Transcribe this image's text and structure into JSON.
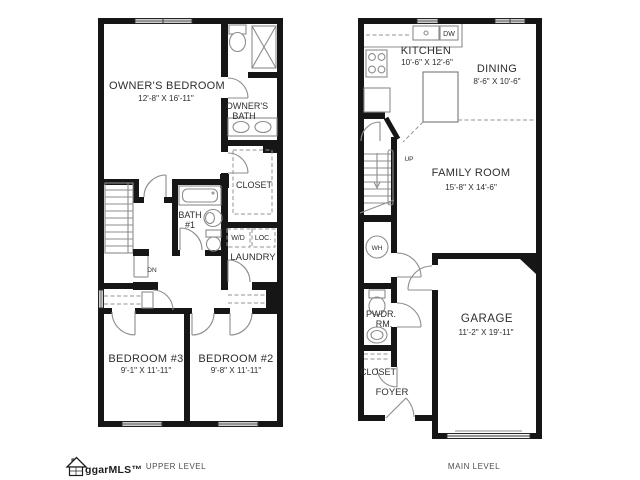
{
  "palette": {
    "wall_ink": "#161616",
    "fixture_line": "#8d8d8d",
    "label_ink": "#2e2e2e",
    "caption_ink": "#4d4d4d"
  },
  "upper_level": {
    "caption": "UPPER LEVEL",
    "rooms": {
      "owners_bedroom": {
        "name": "OWNER'S BEDROOM",
        "dims": "12'-8\" X 16'-11\""
      },
      "owners_bath": {
        "name_line1": "OWNER'S",
        "name_line2": "BATH"
      },
      "closet": {
        "name": "CLOSET"
      },
      "bath1": {
        "name_line1": "BATH",
        "name_line2": "#1"
      },
      "laundry": {
        "name": "LAUNDRY",
        "washer_dryer": "W/D",
        "lockers": "LOC."
      },
      "stairs": {
        "down": "DN"
      },
      "bedroom3": {
        "name": "BEDROOM #3",
        "dims": "9'-1\" X 11'-11\""
      },
      "bedroom2": {
        "name": "BEDROOM #2",
        "dims": "9'-8\" X 11'-11\""
      }
    }
  },
  "main_level": {
    "caption": "MAIN LEVEL",
    "rooms": {
      "kitchen": {
        "name": "KITCHEN",
        "dims": "10'-6\" X 12'-6\"",
        "dishwasher": "DW"
      },
      "dining": {
        "name": "DINING",
        "dims": "8'-6\" X 10'-6\""
      },
      "family_room": {
        "name": "FAMILY ROOM",
        "dims": "15'-8\" X 14'-6\""
      },
      "garage": {
        "name": "GARAGE",
        "dims": "11'-2\" X 19'-11\""
      },
      "stairs": {
        "up": "UP"
      },
      "water_heater": {
        "label": "WH"
      },
      "powder_room": {
        "name_line1": "PWDR.",
        "name_line2": "RM."
      },
      "closet": {
        "name": "CLOSET"
      },
      "foyer": {
        "name": "FOYER"
      }
    }
  },
  "branding": {
    "logo_text": "ggarMLS™"
  }
}
